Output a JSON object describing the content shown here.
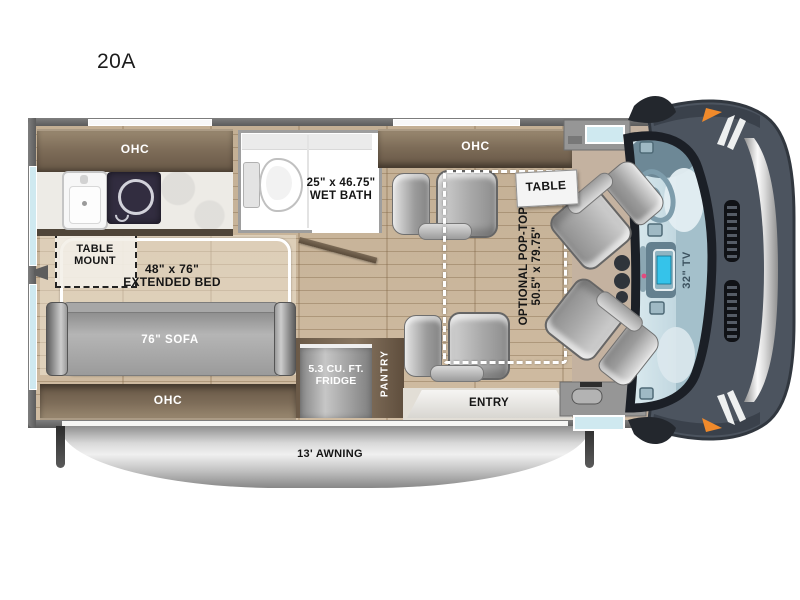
{
  "title": "20A",
  "labels": {
    "ohc_kitchen": "OHC",
    "ohc_front": "OHC",
    "ohc_rear": "OHC",
    "wet_bath_1": "25\" x 46.75\"",
    "wet_bath_2": "WET BATH",
    "table": "TABLE",
    "pop_top_1": "OPTIONAL POP-TOP",
    "pop_top_2": "50.5\" x 79.75\"",
    "table_mount_1": "TABLE",
    "table_mount_2": "MOUNT",
    "bed_1": "48\" x 76\"",
    "bed_2": "EXTENDED BED",
    "sofa": "76\" SOFA",
    "fridge_1": "5.3 CU. FT.",
    "fridge_2": "FRIDGE",
    "pantry": "PANTRY",
    "entry": "ENTRY",
    "awning": "13' AWNING",
    "tv": "32\" TV"
  },
  "colors": {
    "floor_wood": "#cdb89c",
    "cabinet_wood": "#7d6c58",
    "wall_gray": "#666666",
    "seat_gray": "#b5b5b5",
    "cooktop_navy": "#322d40",
    "windshield_blue": "#c9dde4",
    "van_body_slate": "#4c545f",
    "marker_orange": "#f08a2b",
    "awning_silver": "#cccccc",
    "window_blue": "#cfe9f0"
  }
}
